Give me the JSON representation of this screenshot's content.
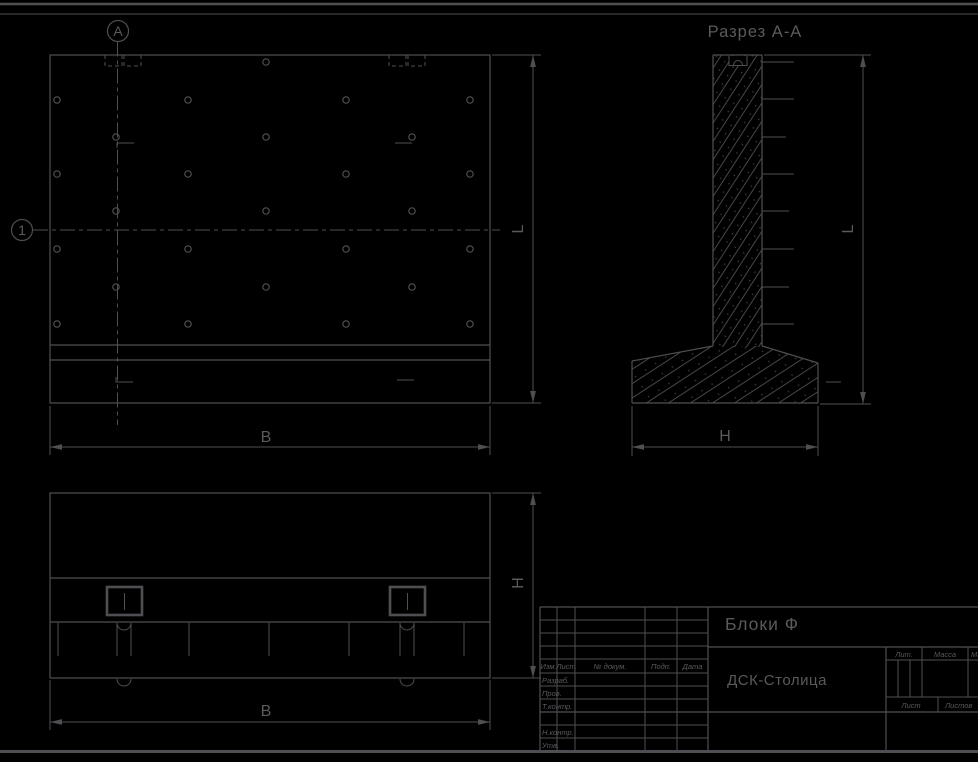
{
  "colors": {
    "background": "#000000",
    "line": "#4f4f53",
    "text": "#5a5a5e",
    "hatch": "#47474b"
  },
  "markers": {
    "section_letter": "А",
    "axis_number": "1"
  },
  "front_view": {
    "dim_width": "B",
    "dim_height": "L"
  },
  "section_view": {
    "title": "Разрез А-А",
    "dim_height": "L",
    "dim_width": "Н"
  },
  "plan_view": {
    "dim_width": "B",
    "dim_height": "Н"
  },
  "title_block": {
    "doc_title": "Блоки Ф",
    "company": "ДСК-Столица",
    "header_cols": [
      "Изм.",
      "Лист",
      "№ докум.",
      "Подп.",
      "Дата"
    ],
    "rows": [
      "Разраб.",
      "Пров.",
      "Т.контр.",
      "",
      "Н.контр.",
      "Утв."
    ],
    "prop_cols": [
      "Лит.",
      "Масса",
      "Масштаб"
    ],
    "sheet_label": "Лист",
    "sheets_label": "Листов"
  }
}
